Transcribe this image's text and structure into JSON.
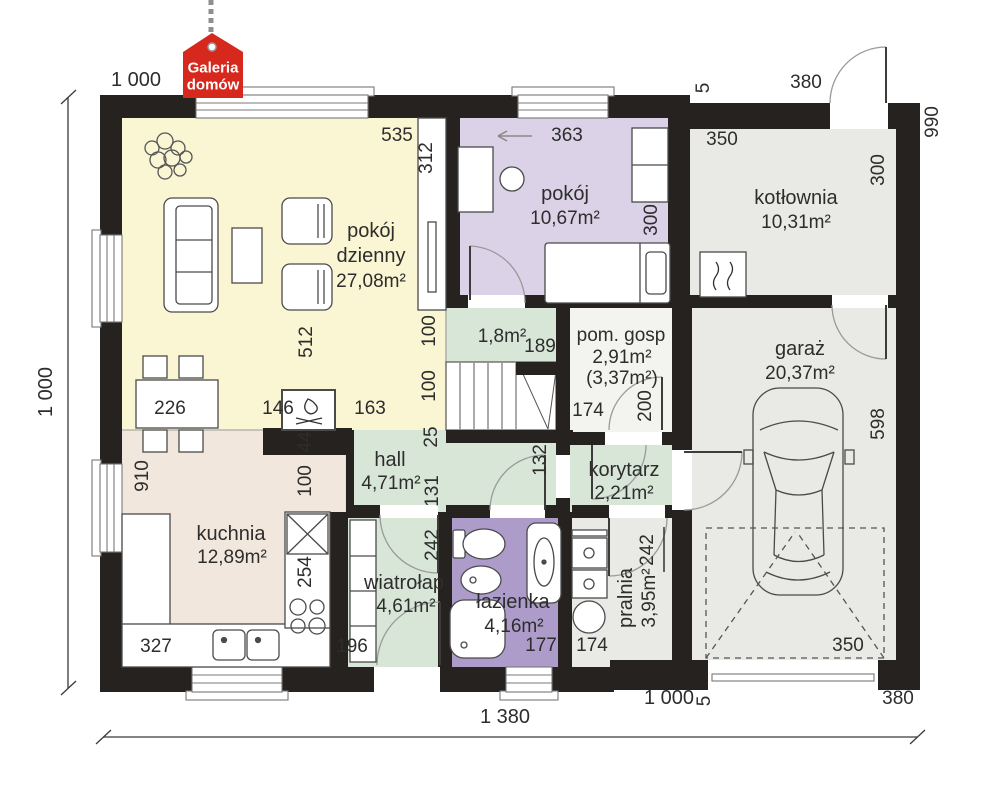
{
  "logo": {
    "line1": "Galeria",
    "line2": "domów",
    "color": "#d6281c"
  },
  "colors": {
    "wall": "#262220",
    "living": "#FAF5D2",
    "bedroom": "#DBD2E7",
    "bathroom": "#AD9CCA",
    "green": "#D8E6D7",
    "kitchen": "#F2E7DC",
    "grey": "#E9E9E6",
    "utility": "#F3F3F0"
  },
  "rooms": {
    "living": {
      "line1": "pokój",
      "line2": "dzienny",
      "area": "27,08m²"
    },
    "bedroom": {
      "name": "pokój",
      "area": "10,67m²"
    },
    "boiler": {
      "name": "kotłownia",
      "area": "10,31m²"
    },
    "garage": {
      "name": "garaż",
      "area": "20,37m²"
    },
    "kitchen": {
      "name": "kuchnia",
      "area": "12,89m²"
    },
    "hall": {
      "name": "hall",
      "area": "4,71m²"
    },
    "vestibule": {
      "name": "wiatrołap",
      "area": "4,61m²"
    },
    "bathroom": {
      "name": "łazienka",
      "area": "4,16m²"
    },
    "laundry": {
      "name": "pralnia",
      "area": "3,95m²"
    },
    "corridor": {
      "name": "korytarz",
      "area": "2,21m²"
    },
    "utility": {
      "name": "pom. gosp",
      "area": "2,91m²",
      "area2": "(3,37m²)"
    },
    "closet": {
      "area": "1,8m²"
    }
  },
  "dimensions": {
    "overall_width": "1 380",
    "overall_height": "1 000",
    "top_left": "1 000",
    "bottom_1000": "1 000",
    "d535": "535",
    "d312": "312",
    "d363": "363",
    "d300_bedroom": "300",
    "d350_boiler": "350",
    "d300_boiler": "300",
    "d990": "990",
    "d380_top": "380",
    "d5_top": "5",
    "d512": "512",
    "d226": "226",
    "d146": "146",
    "d163": "163",
    "d44": "44",
    "d100a": "100",
    "d100b": "100",
    "d25": "25",
    "d131": "131",
    "d242_vest": "242",
    "d189": "189",
    "d174_utility": "174",
    "d200": "200",
    "d132": "132",
    "d910": "910",
    "d100_kitchen": "100",
    "d254": "254",
    "d327": "327",
    "d196": "196",
    "d177": "177",
    "d174_laundry": "174",
    "d242_laundry": "242",
    "d598": "598",
    "d350_garage": "350",
    "d5_bottom": "5",
    "d380_bottom": "380"
  }
}
